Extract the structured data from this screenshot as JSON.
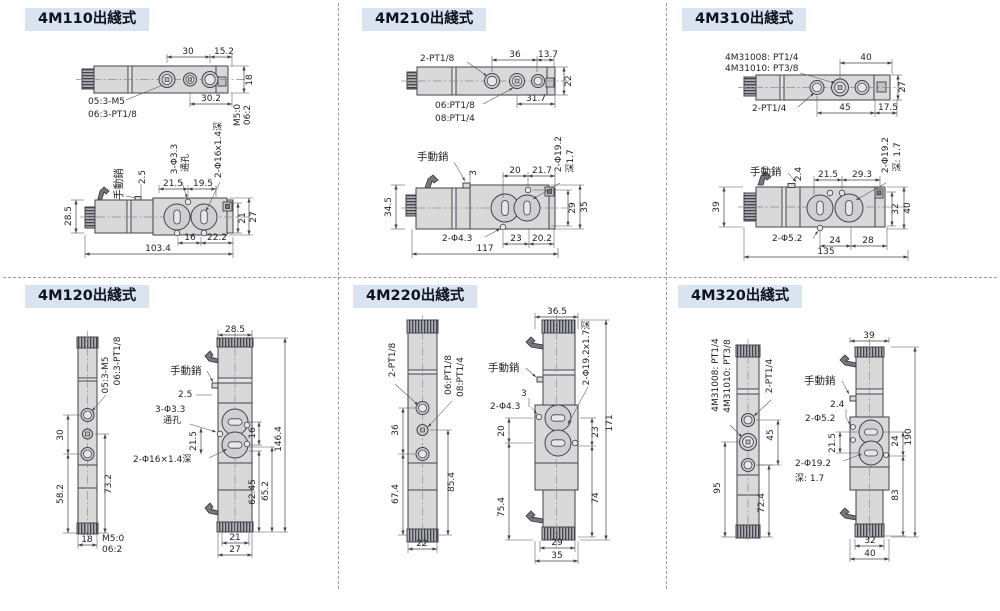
{
  "panels": [
    {
      "title": "4M110出綫式",
      "top": {
        "d30": "30",
        "d15_2": "15.2",
        "d18": "18",
        "d30_2": "30.2",
        "m5": "M5:0",
        "p06": "06:2",
        "l05": "05:3-M5",
        "l06": "06:3-PT1/8"
      },
      "front": {
        "pin": "手動銷",
        "d2_5": "2.5",
        "holes": "3-Φ3.3",
        "thru": "通孔",
        "recess": "2-Φ16x1.4深",
        "d21_5": "21.5",
        "d19_5": "19.5",
        "d28_5": "28.5",
        "d21": "21",
        "d27": "27",
        "d16": "16",
        "d22_2": "22.2",
        "d103_4": "103.4"
      }
    },
    {
      "title": "4M210出綫式",
      "top": {
        "l2pt": "2-PT1/8",
        "d36": "36",
        "d13_7": "13.7",
        "d22": "22",
        "d31_7": "31.7",
        "l06": "06:PT1/8",
        "l08": "08:PT1/4"
      },
      "front": {
        "pin": "手動銷",
        "d3": "3",
        "d20": "20",
        "d21_7": "21.7",
        "recess1": "2-Φ19.2",
        "recess2": "深1.7",
        "d34_5": "34.5",
        "d29": "29",
        "d35": "35",
        "hole": "2-Φ4.3",
        "d23": "23",
        "d20_2": "20.2",
        "d117": "117"
      }
    },
    {
      "title": "4M310出綫式",
      "top": {
        "m1": "4M31008: PT1/4",
        "m2": "4M31010: PT3/8",
        "d40": "40",
        "d27": "27",
        "l2pt": "2-PT1/4",
        "d45": "45",
        "d17_5": "17.5"
      },
      "front": {
        "pin": "手動銷",
        "d2_4": "2.4",
        "d21_5": "21.5",
        "d29_3": "29.3",
        "recess1": "2-Φ19.2",
        "recess2": "深: 1.7",
        "d39": "39",
        "d32": "32",
        "d40": "40",
        "hole": "2-Φ5.2",
        "d24": "24",
        "d28": "28",
        "d135": "135"
      }
    },
    {
      "title": "4M120出綫式",
      "side": {
        "l05": "05:3-M5",
        "l06": "06:3-PT1/8",
        "d30": "30",
        "d58_2": "58.2",
        "d73_2": "73.2",
        "d18": "18",
        "m5": "M5:0",
        "p06": "06:2"
      },
      "front": {
        "d28_5": "28.5",
        "pin": "手動銷",
        "d2_5": "2.5",
        "holes": "3-Φ3.3",
        "thru": "通孔",
        "d21_5": "21.5",
        "recess": "2-Φ16×1.4深",
        "d16": "16",
        "d146_4": "146.4",
        "d62_45": "62.45",
        "d65_2": "65.2",
        "d21": "21",
        "d27": "27"
      }
    },
    {
      "title": "4M220出綫式",
      "side": {
        "l2pt": "2-PT1/8",
        "l06": "06:PT1/8",
        "l08": "08:PT1/4",
        "d36": "36",
        "d67_4": "67.4",
        "d85_4": "85.4",
        "d22": "22"
      },
      "front": {
        "d36_5": "36.5",
        "pin": "手動銷",
        "d3": "3",
        "hole": "2-Φ4.3",
        "recess": "2-Φ19.2x1.7深",
        "d20": "20",
        "d23": "23",
        "d171": "171",
        "d75_4": "75.4",
        "d74": "74",
        "d29": "29",
        "d35": "35"
      }
    },
    {
      "title": "4M320出綫式",
      "side": {
        "m1": "4M31008: PT1/4",
        "m2": "4M31010: PT3/8",
        "l2pt": "2-PT1/4",
        "d45": "45",
        "d95": "95",
        "d72_4": "72.4"
      },
      "front": {
        "d39": "39",
        "pin": "手動銷",
        "d2_4": "2.4",
        "hole": "2-Φ5.2",
        "d21_5": "21.5",
        "recess1": "2-Φ19.2",
        "recess2": "深: 1.7",
        "d24": "24",
        "d190": "190",
        "d83": "83",
        "d32": "32",
        "d40": "40"
      }
    }
  ],
  "colors": {
    "badge_bg": "#d9e4f0",
    "badge_text": "#10131f",
    "line": "#41414b",
    "fill": "#d9d9d9"
  }
}
